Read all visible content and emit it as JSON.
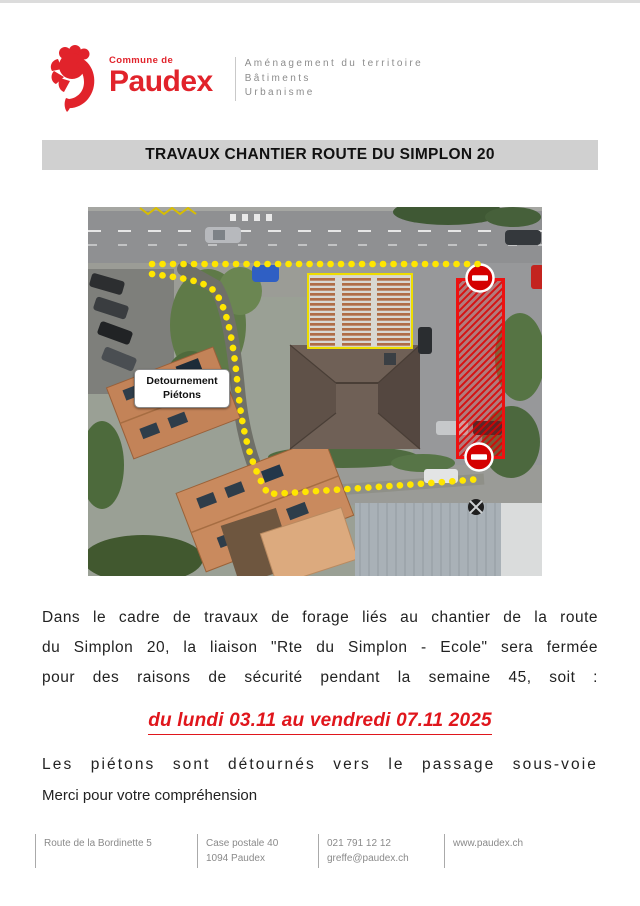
{
  "header": {
    "logo": {
      "commune": "Commune de",
      "name": "Paudex",
      "brand_color": "#e1232b"
    },
    "department_lines": {
      "line1": "Aménagement du territoire",
      "line2": "Bâtiments",
      "line3": "Urbanisme"
    }
  },
  "title_bar": {
    "text": "TRAVAUX CHANTIER ROUTE DU SIMPLON 20",
    "bg": "#d0d0d0"
  },
  "map": {
    "label_line1": "Detournement",
    "label_line2": "Piétons",
    "colors": {
      "diversion_dots": "#ffe600",
      "closed_zone_red": "#ee1111",
      "building_outline_yellow": "#eedd00"
    },
    "icons": [
      "no-entry-sign-top",
      "no-entry-sign-bottom"
    ]
  },
  "body": {
    "paragraph_line1": "Dans le cadre de travaux de forage liés au chantier de la route",
    "paragraph_line2": "du Simplon 20, la liaison \"Rte du Simplon - Ecole\" sera fermée",
    "paragraph_line3": "pour des raisons de sécurité pendant la semaine 45, soit :",
    "date_line": "du lundi 03.11 au vendredi 07.11 2025",
    "date_color": "#e0161c",
    "detour_line": "Les piétons sont détournés vers le passage sous-voie",
    "thanks_line": "Merci pour votre compréhension"
  },
  "footer": {
    "col1_line1": "Route de la Bordinette 5",
    "col2_line1": "Case postale 40",
    "col2_line2": "1094 Paudex",
    "col3_line1": "021 791 12 12",
    "col3_line2": "greffe@paudex.ch",
    "col4_line1": "www.paudex.ch"
  }
}
